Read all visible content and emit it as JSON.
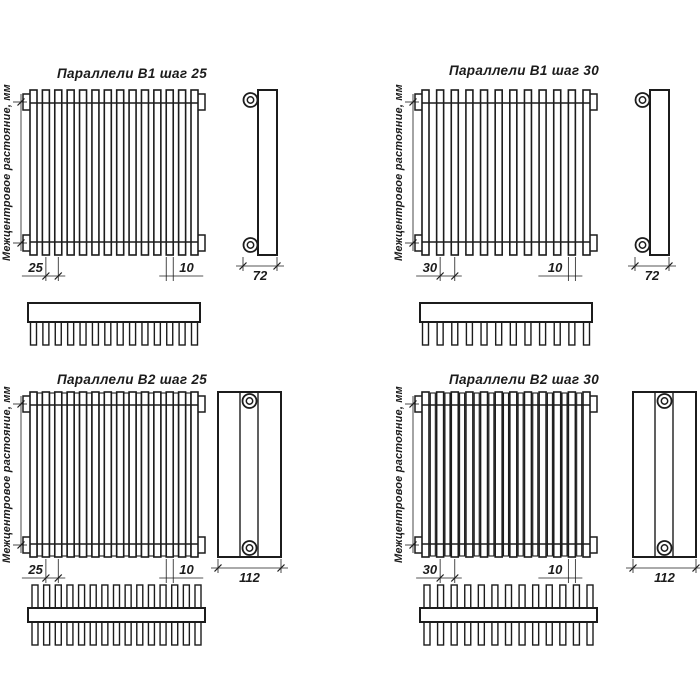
{
  "drawing": {
    "background": "#ffffff",
    "line_color": "#1c1c1c",
    "axis_label": "Межцентровое растояние, мм",
    "tube_width_dim": "10",
    "quadrants": [
      {
        "id": "b1-step-25",
        "title": "Параллели В1 шаг 25",
        "series": "В1",
        "step_dim": "25",
        "tube_dim": "10",
        "depth_dim": "72",
        "rows": 1,
        "front_tubes": 14,
        "section_teeth": 14
      },
      {
        "id": "b1-step-30",
        "title": "Параллели В1 шаг 30",
        "series": "В1",
        "step_dim": "30",
        "tube_dim": "10",
        "depth_dim": "72",
        "rows": 1,
        "front_tubes": 12,
        "section_teeth": 12
      },
      {
        "id": "b2-step-25",
        "title": "Параллели В2 шаг 25",
        "series": "В2",
        "step_dim": "25",
        "tube_dim": "10",
        "depth_dim": "112",
        "rows": 2,
        "front_tubes": 14,
        "section_teeth": 15
      },
      {
        "id": "b2-step-30",
        "title": "Параллели В2 шаг 30",
        "series": "В2",
        "step_dim": "30",
        "tube_dim": "10",
        "depth_dim": "112",
        "rows": 2,
        "front_tubes": 12,
        "section_teeth": 13
      }
    ]
  }
}
